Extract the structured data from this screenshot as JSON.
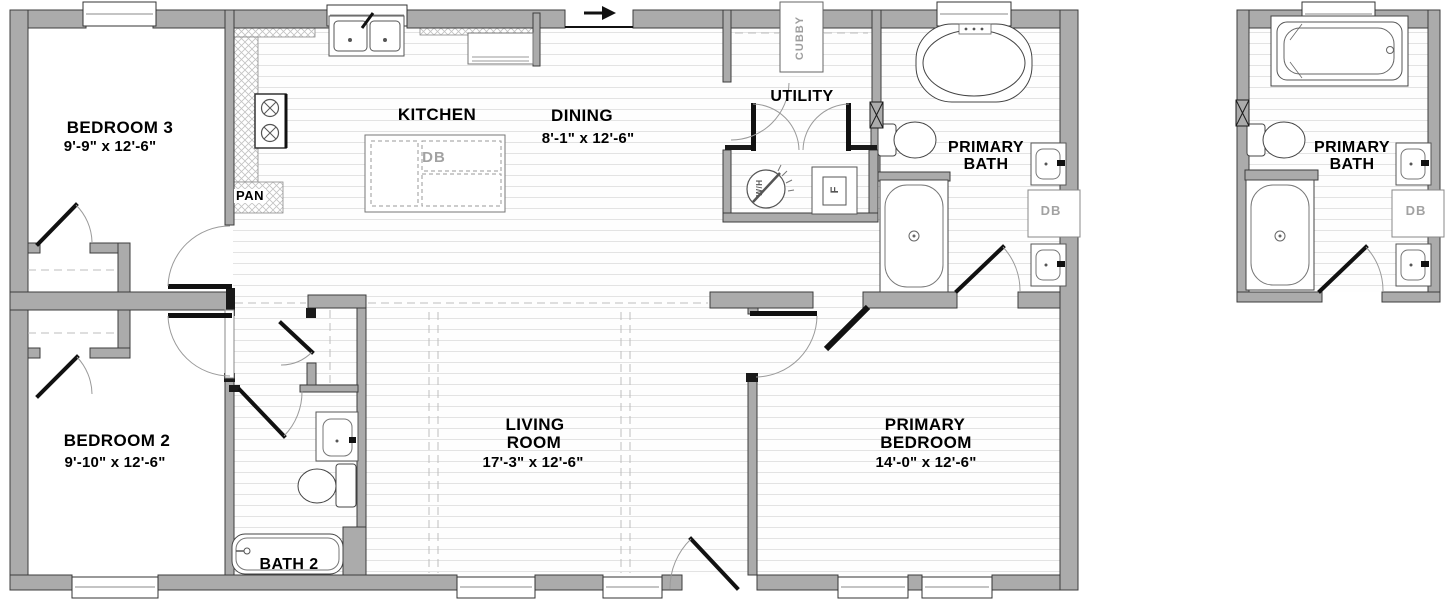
{
  "plan": {
    "rooms": {
      "bedroom3": {
        "label": "BEDROOM 3",
        "dims": "9'-9\" x  12'-6\""
      },
      "kitchen": {
        "label": "KITCHEN"
      },
      "dining": {
        "label": "DINING",
        "dims": "8'-1\" x  12'-6\""
      },
      "utility": {
        "label": "UTILITY"
      },
      "primary_bath": {
        "label_line1": "PRIMARY",
        "label_line2": "BATH"
      },
      "bedroom2": {
        "label": "BEDROOM 2",
        "dims": "9'-10\" x  12'-6\""
      },
      "living_room": {
        "label_line1": "LIVING",
        "label_line2": "ROOM",
        "dims": "17'-3\" x  12'-6\""
      },
      "primary_bedroom": {
        "label_line1": "PRIMARY",
        "label_line2": "BEDROOM",
        "dims": "14'-0\" x  12'-6\""
      },
      "bath2": {
        "label": "BATH 2"
      }
    },
    "detail_option": {
      "primary_bath": {
        "label_line1": "PRIMARY",
        "label_line2": "BATH",
        "cabinet": "DB"
      }
    },
    "annotations": {
      "pantry": "PAN",
      "cubby": "CUBBY",
      "island_cabinet": "DB",
      "bath_cabinet": "DB",
      "water_heater": "W/H",
      "furnace": "F"
    },
    "colors": {
      "wall_fill": "#ababab",
      "wall_stroke": "#3c3c3c",
      "plank_line": "#e3e3e3",
      "door_arc": "#9a9a9a",
      "gray_label": "#a2a2a2"
    }
  }
}
